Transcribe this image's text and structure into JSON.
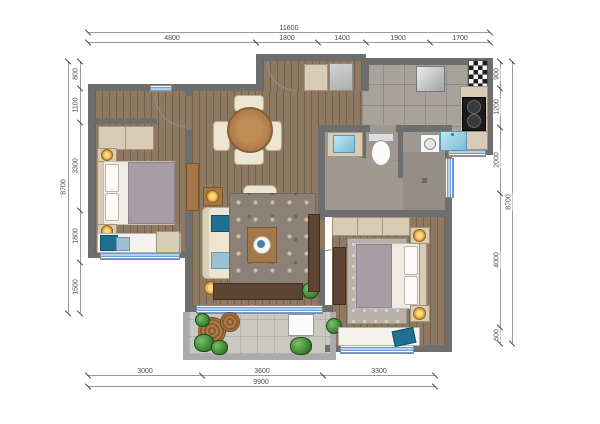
{
  "plan": {
    "type": "apartment floor plan, top view, no text labels besides dimensions"
  },
  "dimensions": {
    "top": {
      "total": "11600",
      "segments": [
        "4800",
        "1800",
        "1400",
        "1900",
        "1700"
      ]
    },
    "left": {
      "total": "8700",
      "segments": [
        "800",
        "1100",
        "3300",
        "1800",
        "1500"
      ]
    },
    "right": {
      "total": "8700",
      "segments": [
        "900",
        "1200",
        "2000",
        "4000",
        "600"
      ]
    },
    "bottom": {
      "total": "9900",
      "segments": [
        "3000",
        "3600",
        "3300"
      ]
    }
  },
  "colors": {
    "wall": "#6e6e6e",
    "wood_floor": "#8e7962",
    "tile_floor": "#a7a29a",
    "balcony_tile": "#c9c9c2",
    "cabinet_beige": "#d8ccb6",
    "accent_teal": "#20708f",
    "lamp_gold": "#dc9c32",
    "plant_green": "#3f8836",
    "window_blue": "#6f9ed6"
  }
}
